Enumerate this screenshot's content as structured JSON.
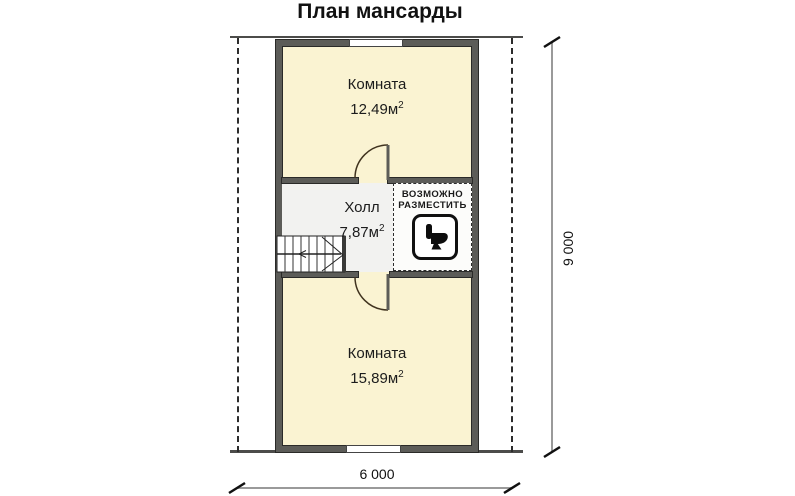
{
  "title": "План мансарды",
  "plan": {
    "top_room": {
      "label": "Комната",
      "area": "12,49м",
      "area_sup": "2"
    },
    "hall": {
      "label": "Холл",
      "area": "7,87м",
      "area_sup": "2"
    },
    "bottom_room": {
      "label": "Комната",
      "area": "15,89м",
      "area_sup": "2"
    },
    "placement_zone": {
      "line1": "ВОЗМОЖНО",
      "line2": "РАЗМЕСТИТЬ"
    }
  },
  "dimensions": {
    "horizontal": "6 000",
    "vertical": "9 000"
  },
  "icons": {
    "toilet": "toilet-icon"
  },
  "colors": {
    "background": "#ffffff",
    "room_fill": "#faf3d2",
    "hall_fill": "#f2f2f0",
    "wall": "#5c5c58",
    "dimension_line": "#9a9a9a",
    "door_arc": "#40331f"
  }
}
